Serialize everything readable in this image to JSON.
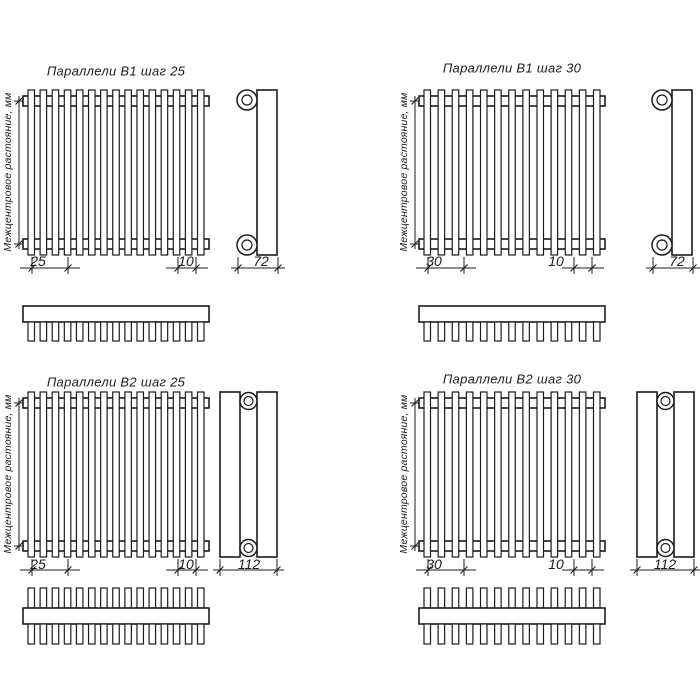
{
  "colors": {
    "line": "#1c1c1c",
    "background": "#ffffff"
  },
  "axis_label": "Межцентровое растояние, мм",
  "quadrants": [
    {
      "id": "b1-step25",
      "title": "Параллели В1 шаг 25",
      "step": "25",
      "end": "10",
      "depth": "72",
      "tubes": 15,
      "rows": 1
    },
    {
      "id": "b1-step30",
      "title": "Параллели В1 шаг 30",
      "step": "30",
      "end": "10",
      "depth": "72",
      "tubes": 13,
      "rows": 1
    },
    {
      "id": "b2-step25",
      "title": "Параллели В2 шаг 25",
      "step": "25",
      "end": "10",
      "depth": "112",
      "tubes": 15,
      "rows": 2
    },
    {
      "id": "b2-step30",
      "title": "Параллели В2 шаг 30",
      "step": "30",
      "end": "10",
      "depth": "112",
      "tubes": 13,
      "rows": 2
    }
  ]
}
